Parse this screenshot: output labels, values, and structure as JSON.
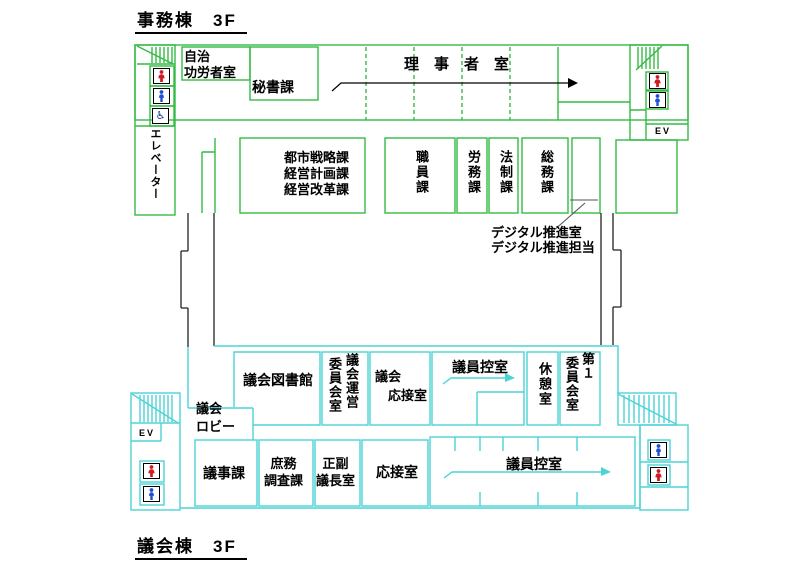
{
  "colors": {
    "office_wall": "#33bb44",
    "assembly_wall": "#4cd3d6",
    "leader_line": "#555555",
    "text": "#000000",
    "icon_female_red": "#d01a24",
    "icon_male_blue": "#1d4fd6",
    "icon_accessible_blue": "#0b3a99"
  },
  "titles": {
    "office": "事務棟　3F",
    "assembly": "議会棟　3F"
  },
  "office": {
    "rooms": {
      "jichi_korosha": "自治\n功労者室",
      "hisho": "秘書課",
      "rijisha": "理　事　者　室",
      "elevator": "エレベーター",
      "ev": "EV",
      "toshi": "都市戦略課\n経営計画課\n経営改革課",
      "shokuin": "職員課",
      "romu": "労務課",
      "hosei": "法制課",
      "somu": "総務課",
      "digital": "デジタル推進室\nデジタル推進担当"
    }
  },
  "assembly": {
    "rooms": {
      "toshokan": "議会図書館",
      "unei_col_right": "議会運営",
      "unei_col_left": "委員会室",
      "gikai_osetsu": "議会\n　応接室",
      "giin_hikae_upper": "議員控室",
      "kyukei": "休憩室",
      "dai1_col_right": "第１",
      "dai1_col_left": "委員会室",
      "lobby": "議会\nロビー",
      "ev": "EV",
      "giji": "議事課",
      "shomu": "庶務\n調査課",
      "seifuku": "正副\n議長室",
      "osetsu": "応接室",
      "giin_hikae_lower": "議員控室"
    }
  },
  "icons": {
    "female": "female-restroom",
    "male": "male-restroom",
    "accessible": "accessible-restroom",
    "stairs": "stairs",
    "elevator_short": "EV"
  }
}
